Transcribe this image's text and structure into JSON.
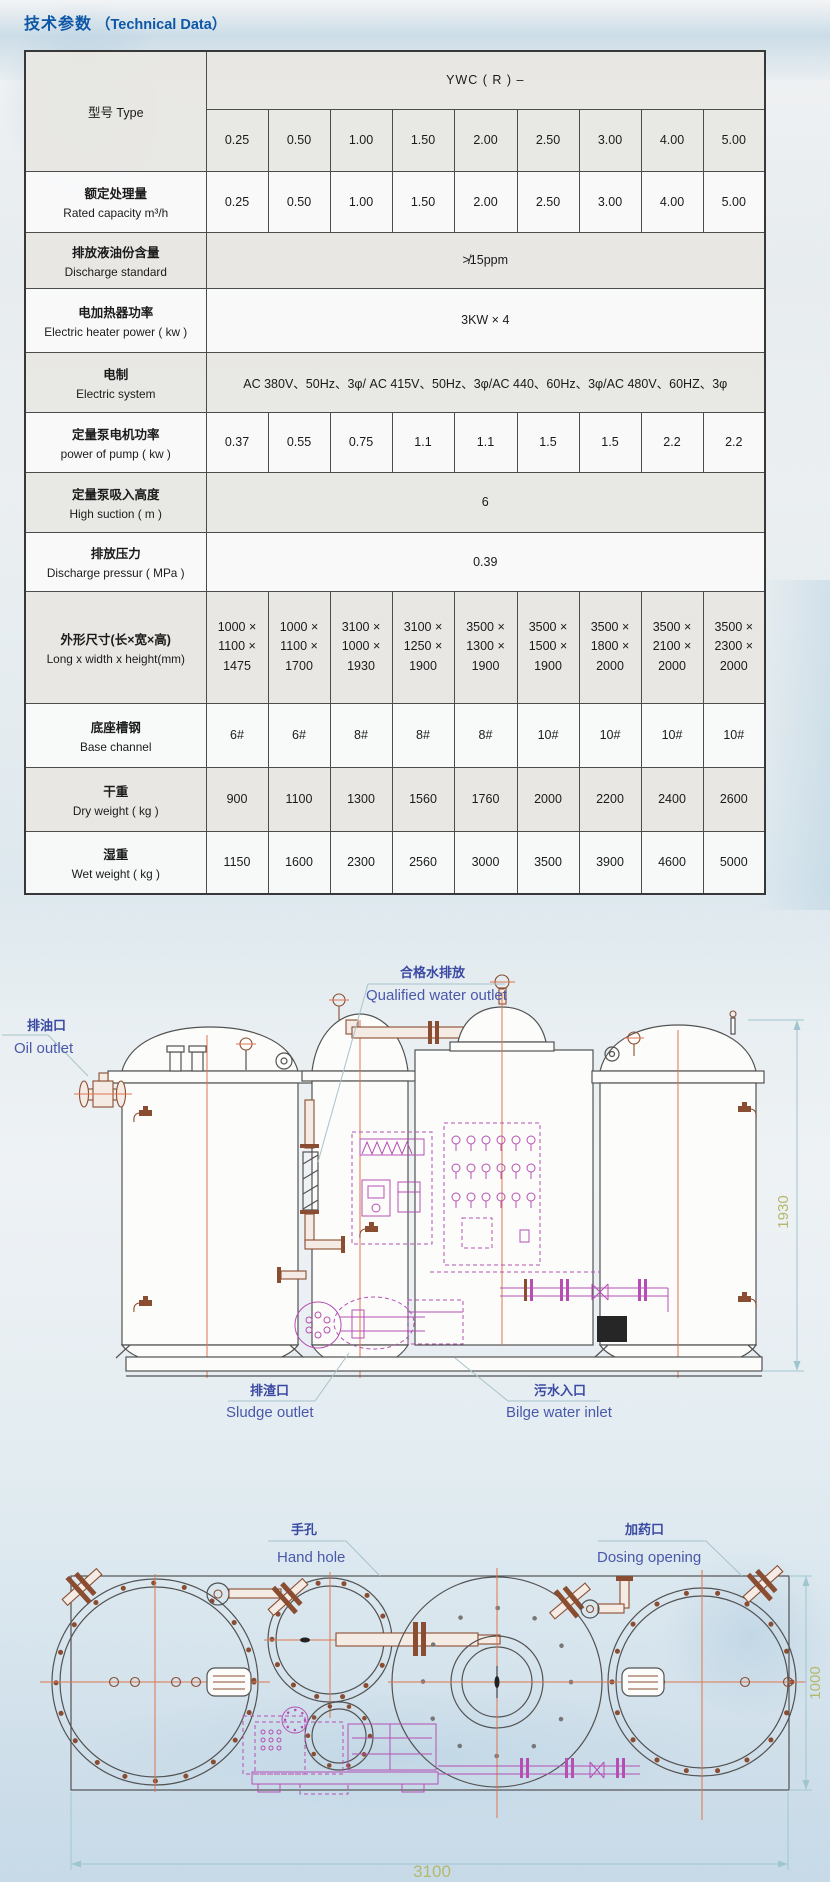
{
  "page": {
    "title_cn": "技术参数",
    "title_en": "（Technical Data）"
  },
  "colors": {
    "title_blue": "#0d57a6",
    "diagram_label_blue": "#4a58aa",
    "dimension_olive": "#b4b86c",
    "centerline_orange": "#e0744d",
    "pipe_brown": "#8a4d31",
    "pump_magenta": "#b54fb3",
    "dimension_cyan": "#9fc6cf"
  },
  "table": {
    "type_label": "型号 Type",
    "series_header": "YWC ( R ) –",
    "sizes": [
      "0.25",
      "0.50",
      "1.00",
      "1.50",
      "2.00",
      "2.50",
      "3.00",
      "4.00",
      "5.00"
    ],
    "rows": [
      {
        "cn": "额定处理量",
        "en": "Rated capacity  m³/h",
        "values": [
          "0.25",
          "0.50",
          "1.00",
          "1.50",
          "2.00",
          "2.50",
          "3.00",
          "4.00",
          "5.00"
        ]
      },
      {
        "cn": "排放液油份含量",
        "en": "Discharge standard",
        "span": "≯15ppm"
      },
      {
        "cn": "电加热器功率",
        "en": "Electric heater power ( kw )",
        "span": "3KW × 4"
      },
      {
        "cn": "电制",
        "en": "Electric system",
        "span": "AC 380V、50Hz、3φ/ AC 415V、50Hz、3φ/AC 440、60Hz、3φ/AC 480V、60HZ、3φ"
      },
      {
        "cn": "定量泵电机功率",
        "en": "power of pump ( kw )",
        "values": [
          "0.37",
          "0.55",
          "0.75",
          "1.1",
          "1.1",
          "1.5",
          "1.5",
          "2.2",
          "2.2"
        ]
      },
      {
        "cn": "定量泵吸入高度",
        "en": "High suction ( m )",
        "span": "6"
      },
      {
        "cn": "排放压力",
        "en": "Discharge pressur ( MPa )",
        "span": "0.39"
      },
      {
        "cn": "外形尺寸(长×宽×高)",
        "en": "Long x width x height(mm)",
        "pre": true,
        "values": [
          "1000 ×\n1100 ×\n1475",
          "1000 ×\n1100 ×\n1700",
          "3100 ×\n1000 ×\n1930",
          "3100 ×\n1250 ×\n1900",
          "3500 ×\n1300 ×\n1900",
          "3500 ×\n1500 ×\n1900",
          "3500 ×\n1800 ×\n2000",
          "3500 ×\n2100 ×\n2000",
          "3500 ×\n2300 ×\n2000"
        ]
      },
      {
        "cn": "底座槽钢",
        "en": "Base channel",
        "values": [
          "6#",
          "6#",
          "8#",
          "8#",
          "8#",
          "10#",
          "10#",
          "10#",
          "10#"
        ]
      },
      {
        "cn": "干重",
        "en": "Dry weight ( kg )",
        "values": [
          "900",
          "1100",
          "1300",
          "1560",
          "1760",
          "2000",
          "2200",
          "2400",
          "2600"
        ]
      },
      {
        "cn": "湿重",
        "en": "Wet weight ( kg )",
        "values": [
          "1150",
          "1600",
          "2300",
          "2560",
          "3000",
          "3500",
          "3900",
          "4600",
          "5000"
        ]
      }
    ]
  },
  "side_view": {
    "oil_outlet_cn": "排油口",
    "oil_outlet_en": "Oil outlet",
    "qualified_water_cn": "合格水排放",
    "qualified_water_en": "Qualified water outlet",
    "sludge_outlet_cn": "排渣口",
    "sludge_outlet_en": "Sludge outlet",
    "bilge_inlet_cn": "污水入口",
    "bilge_inlet_en": "Bilge water inlet",
    "height_dim": "1930"
  },
  "plan_view": {
    "hand_hole_cn": "手孔",
    "hand_hole_en": "Hand hole",
    "dosing_cn": "加药口",
    "dosing_en": "Dosing opening",
    "length_dim": "3100",
    "width_dim": "1000"
  }
}
